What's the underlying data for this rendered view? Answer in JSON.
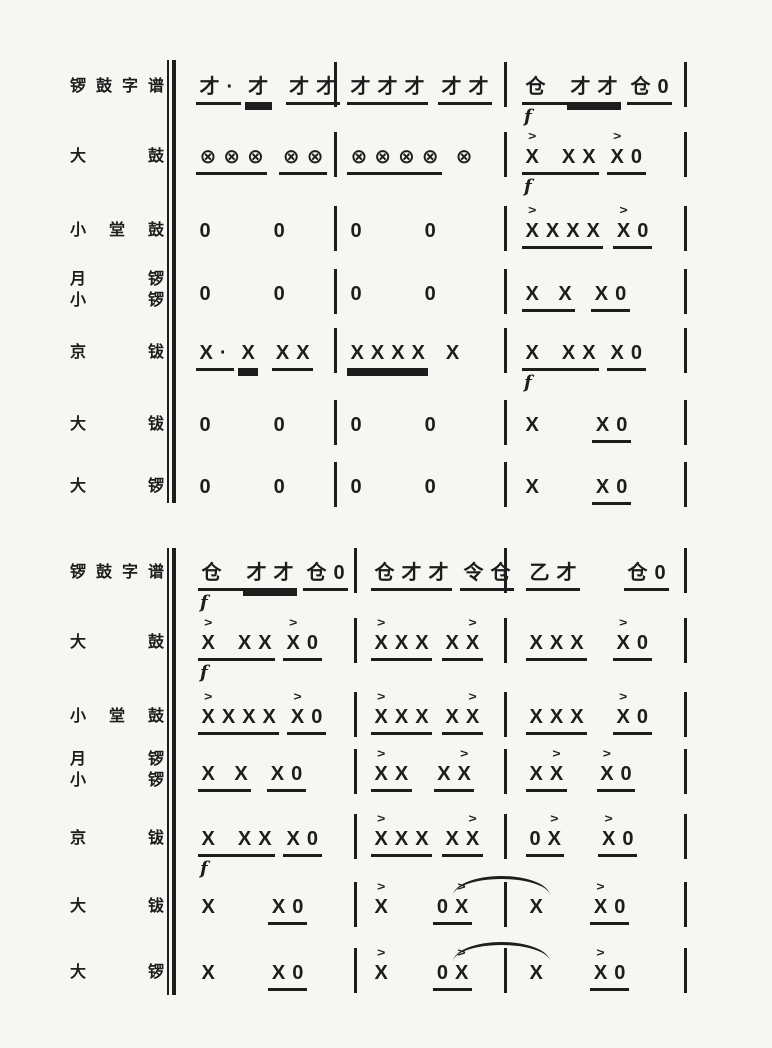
{
  "colors": {
    "paper": "#f7f6f2",
    "ink": "#1d1d1d"
  },
  "notation": {
    "accent_mark": ">",
    "forte_mark": "f"
  },
  "systems": [
    {
      "name": "system-1",
      "rows": [
        {
          "label_lines": [
            "锣鼓字谱"
          ],
          "measures": [
            {
              "groups": [
                {
                  "t": "才·",
                  "u": 1,
                  "pad": 4
                },
                {
                  "t": "才",
                  "u": 2,
                  "ml": 4
                },
                {
                  "t": "才才",
                  "u": 1,
                  "ml": 14
                }
              ]
            },
            {
              "groups": [
                {
                  "t": "才才才",
                  "u": 1
                },
                {
                  "t": "才才",
                  "u": 1,
                  "ml": 10
                }
              ]
            },
            {
              "groups": [
                {
                  "t": "仓",
                  "u": 1,
                  "pad": 18
                },
                {
                  "t": "才才",
                  "u": 2
                },
                {
                  "t": "仓0",
                  "u": 1,
                  "ml": 6
                }
              ],
              "f": "below"
            }
          ]
        },
        {
          "label_lines": [
            "大鼓"
          ],
          "measures": [
            {
              "groups": [
                {
                  "t": "⊗⊗⊗",
                  "u": 1
                },
                {
                  "t": "⊗⊗",
                  "u": 1,
                  "ml": 12
                }
              ]
            },
            {
              "groups": [
                {
                  "t": "⊗⊗⊗⊗",
                  "u": 1
                },
                {
                  "t": "⊗",
                  "u": 0,
                  "ml": 10
                }
              ]
            },
            {
              "groups": [
                {
                  "t": "X",
                  "u": 1,
                  "pad": 16,
                  "acc": [
                    0
                  ]
                },
                {
                  "t": "XX",
                  "u": 1
                },
                {
                  "t": "X0",
                  "u": 1,
                  "ml": 8,
                  "acc": [
                    0
                  ]
                }
              ],
              "f": "below"
            }
          ]
        },
        {
          "label_lines": [
            "小堂鼓"
          ],
          "measures": [
            {
              "groups": [
                {
                  "t": "0"
                },
                {
                  "t": "0",
                  "ml": 56
                }
              ]
            },
            {
              "groups": [
                {
                  "t": "0"
                },
                {
                  "t": "0",
                  "ml": 56
                }
              ]
            },
            {
              "groups": [
                {
                  "t": "XXXX",
                  "u": 1,
                  "acc": [
                    0
                  ]
                },
                {
                  "t": "X0",
                  "u": 1,
                  "ml": 10,
                  "acc": [
                    0
                  ]
                }
              ]
            }
          ]
        },
        {
          "label_lines": [
            "月锣",
            "小锣"
          ],
          "measures": [
            {
              "groups": [
                {
                  "t": "0"
                },
                {
                  "t": "0",
                  "ml": 56
                }
              ]
            },
            {
              "groups": [
                {
                  "t": "0"
                },
                {
                  "t": "0",
                  "ml": 56
                }
              ]
            },
            {
              "groups": [
                {
                  "t": "X X",
                  "u": 1
                },
                {
                  "t": "X0",
                  "u": 1,
                  "ml": 16
                }
              ]
            }
          ]
        },
        {
          "label_lines": [
            "京钹"
          ],
          "measures": [
            {
              "groups": [
                {
                  "t": "X·",
                  "u": 1,
                  "pad": 4
                },
                {
                  "t": "X",
                  "u": 2,
                  "ml": 4
                },
                {
                  "t": "XX",
                  "u": 1,
                  "ml": 14
                }
              ]
            },
            {
              "groups": [
                {
                  "t": "XXXX",
                  "u": 2
                },
                {
                  "t": "X",
                  "u": 0,
                  "ml": 14
                }
              ]
            },
            {
              "groups": [
                {
                  "t": "X",
                  "u": 1,
                  "pad": 16
                },
                {
                  "t": "XX",
                  "u": 1
                },
                {
                  "t": "X0",
                  "u": 1,
                  "ml": 8
                }
              ],
              "f": "below"
            }
          ]
        },
        {
          "label_lines": [
            "大钹"
          ],
          "measures": [
            {
              "groups": [
                {
                  "t": "0"
                },
                {
                  "t": "0",
                  "ml": 56
                }
              ]
            },
            {
              "groups": [
                {
                  "t": "0"
                },
                {
                  "t": "0",
                  "ml": 56
                }
              ]
            },
            {
              "groups": [
                {
                  "t": "X"
                },
                {
                  "t": "X0",
                  "u": 1,
                  "ml": 50
                }
              ]
            }
          ]
        },
        {
          "label_lines": [
            "大锣"
          ],
          "measures": [
            {
              "groups": [
                {
                  "t": "0"
                },
                {
                  "t": "0",
                  "ml": 56
                }
              ]
            },
            {
              "groups": [
                {
                  "t": "0"
                },
                {
                  "t": "0",
                  "ml": 56
                }
              ]
            },
            {
              "groups": [
                {
                  "t": "X"
                },
                {
                  "t": "X0",
                  "u": 1,
                  "ml": 50
                }
              ]
            }
          ]
        }
      ]
    },
    {
      "name": "system-2",
      "rows": [
        {
          "label_lines": [
            "锣鼓字谱"
          ],
          "measures": [
            {
              "groups": [
                {
                  "t": "仓",
                  "u": 1,
                  "pad": 18
                },
                {
                  "t": "才才",
                  "u": 2
                },
                {
                  "t": "仓0",
                  "u": 1,
                  "ml": 6
                }
              ],
              "f": "below"
            },
            {
              "groups": [
                {
                  "t": "仓才才",
                  "u": 1
                },
                {
                  "t": "令仓",
                  "u": 1,
                  "ml": 8
                }
              ]
            },
            {
              "groups": [
                {
                  "t": "乙才",
                  "u": 1
                },
                {
                  "t": "仓0",
                  "u": 1,
                  "ml": 44
                }
              ]
            }
          ]
        },
        {
          "label_lines": [
            "大鼓"
          ],
          "measures": [
            {
              "groups": [
                {
                  "t": "X",
                  "u": 1,
                  "pad": 16,
                  "acc": [
                    0
                  ]
                },
                {
                  "t": "XX",
                  "u": 1
                },
                {
                  "t": "X0",
                  "u": 1,
                  "ml": 8,
                  "acc": [
                    0
                  ]
                }
              ],
              "f": "below"
            },
            {
              "groups": [
                {
                  "t": "XXX",
                  "u": 1,
                  "acc": [
                    0
                  ]
                },
                {
                  "t": "XX",
                  "u": 1,
                  "ml": 10,
                  "acc": [
                    1
                  ]
                }
              ]
            },
            {
              "groups": [
                {
                  "t": "XXX",
                  "u": 1
                },
                {
                  "t": "X0",
                  "u": 1,
                  "ml": 26,
                  "acc": [
                    0
                  ]
                }
              ]
            }
          ]
        },
        {
          "label_lines": [
            "小堂鼓"
          ],
          "measures": [
            {
              "groups": [
                {
                  "t": "XXXX",
                  "u": 1,
                  "acc": [
                    0
                  ]
                },
                {
                  "t": "X0",
                  "u": 1,
                  "ml": 8,
                  "acc": [
                    0
                  ]
                }
              ]
            },
            {
              "groups": [
                {
                  "t": "XXX",
                  "u": 1,
                  "acc": [
                    0
                  ]
                },
                {
                  "t": "XX",
                  "u": 1,
                  "ml": 10,
                  "acc": [
                    1
                  ]
                }
              ]
            },
            {
              "groups": [
                {
                  "t": "XXX",
                  "u": 1
                },
                {
                  "t": "X0",
                  "u": 1,
                  "ml": 26,
                  "acc": [
                    0
                  ]
                }
              ]
            }
          ]
        },
        {
          "label_lines": [
            "月锣",
            "小锣"
          ],
          "measures": [
            {
              "groups": [
                {
                  "t": "X X",
                  "u": 1
                },
                {
                  "t": "X0",
                  "u": 1,
                  "ml": 16
                }
              ]
            },
            {
              "groups": [
                {
                  "t": "XX",
                  "u": 1,
                  "acc": [
                    0
                  ]
                },
                {
                  "t": "XX",
                  "u": 1,
                  "ml": 22,
                  "acc": [
                    1
                  ]
                }
              ]
            },
            {
              "groups": [
                {
                  "t": "XX",
                  "u": 1,
                  "acc": [
                    1
                  ]
                },
                {
                  "t": "X0",
                  "u": 1,
                  "ml": 30,
                  "acc": [
                    0
                  ]
                }
              ]
            }
          ]
        },
        {
          "label_lines": [
            "京钹"
          ],
          "measures": [
            {
              "groups": [
                {
                  "t": "X",
                  "u": 1,
                  "pad": 16
                },
                {
                  "t": "XX",
                  "u": 1
                },
                {
                  "t": "X0",
                  "u": 1,
                  "ml": 8
                }
              ],
              "f": "below"
            },
            {
              "groups": [
                {
                  "t": "XXX",
                  "u": 1,
                  "acc": [
                    0
                  ]
                },
                {
                  "t": "XX",
                  "u": 1,
                  "ml": 10,
                  "acc": [
                    1
                  ]
                }
              ]
            },
            {
              "groups": [
                {
                  "t": "0X",
                  "u": 1,
                  "acc": [
                    1
                  ]
                },
                {
                  "t": "X0",
                  "u": 1,
                  "ml": 34,
                  "acc": [
                    0
                  ]
                }
              ]
            }
          ]
        },
        {
          "label_lines": [
            "大钹"
          ],
          "measures": [
            {
              "groups": [
                {
                  "t": "X"
                },
                {
                  "t": "X0",
                  "u": 1,
                  "ml": 50
                }
              ]
            },
            {
              "groups": [
                {
                  "t": "X",
                  "acc": [
                    0
                  ]
                },
                {
                  "t": "0X",
                  "u": 1,
                  "ml": 42,
                  "acc": [
                    1
                  ]
                }
              ],
              "tie_after": true
            },
            {
              "groups": [
                {
                  "t": "X"
                },
                {
                  "t": "X0",
                  "u": 1,
                  "ml": 44,
                  "acc": [
                    0
                  ]
                }
              ]
            }
          ]
        },
        {
          "label_lines": [
            "大锣"
          ],
          "measures": [
            {
              "groups": [
                {
                  "t": "X"
                },
                {
                  "t": "X0",
                  "u": 1,
                  "ml": 50
                }
              ]
            },
            {
              "groups": [
                {
                  "t": "X",
                  "acc": [
                    0
                  ]
                },
                {
                  "t": "0X",
                  "u": 1,
                  "ml": 42,
                  "acc": [
                    1
                  ]
                }
              ],
              "tie_after": true
            },
            {
              "groups": [
                {
                  "t": "X"
                },
                {
                  "t": "X0",
                  "u": 1,
                  "ml": 44,
                  "acc": [
                    0
                  ]
                }
              ]
            }
          ]
        }
      ]
    }
  ]
}
